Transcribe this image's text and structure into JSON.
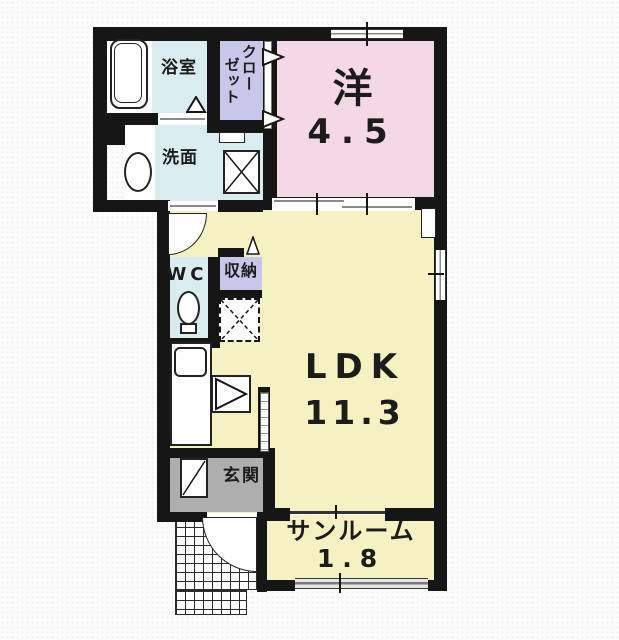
{
  "plan": {
    "title": "floor-plan",
    "rooms": {
      "bathroom": {
        "name": "浴室"
      },
      "washroom": {
        "name": "洗面"
      },
      "closet": {
        "name_line1": "クロー",
        "name_line2": "ゼット"
      },
      "western": {
        "name": "洋",
        "area": "4.5"
      },
      "wc": {
        "name": "WC"
      },
      "storage": {
        "name": "収納"
      },
      "ldk": {
        "name": "LDK",
        "area": "11.3"
      },
      "entrance": {
        "name": "玄関"
      },
      "sunroom": {
        "name": "サンルーム",
        "area": "1.8"
      }
    },
    "colors": {
      "wall": "#161616",
      "western_room": "#f3d8e6",
      "ldk_room": "#f5f1c3",
      "wet_room": "#d9edf0",
      "closet_room": "#c9c7e9",
      "entrance_floor": "#aeaeae"
    }
  }
}
